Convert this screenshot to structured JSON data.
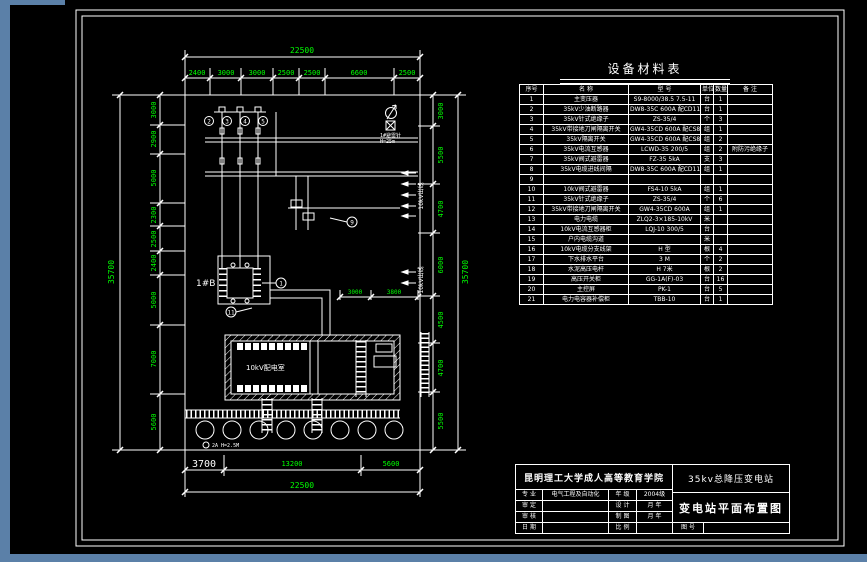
{
  "colors": {
    "backdrop": "#5b80a8",
    "paper": "#000000",
    "line": "#ffffff",
    "dim": "#00ff00"
  },
  "equipment_table": {
    "title": "设备材料表",
    "columns": [
      "序号",
      "名  称",
      "型    号",
      "单位",
      "数量",
      "备 注"
    ],
    "rows": [
      {
        "no": "1",
        "name": "主变压器",
        "model": "S9-8000/38.5 7.5-11",
        "unit": "台",
        "qty": "1",
        "note": ""
      },
      {
        "no": "2",
        "name": "35kV少油断路器",
        "model": "DW8-35C 600A 配CD11-3",
        "unit": "台",
        "qty": "1",
        "note": ""
      },
      {
        "no": "3",
        "name": "35kV针式绝缘子",
        "model": "ZS-35/4",
        "unit": "个",
        "qty": "3",
        "note": ""
      },
      {
        "no": "4",
        "name": "35kV带接地刀闸隔离开关",
        "model": "GW4-35CD 600A 配CS8-6D机构",
        "unit": "组",
        "qty": "1",
        "note": ""
      },
      {
        "no": "5",
        "name": "35kV隔离开关",
        "model": "GW4-35CD 600A 配CS8-6D",
        "unit": "组",
        "qty": "2",
        "note": ""
      },
      {
        "no": "6",
        "name": "35kV电流互感器",
        "model": "LCWD-35 200/5",
        "unit": "组",
        "qty": "2",
        "note": "附防污绝缘子"
      },
      {
        "no": "7",
        "name": "35kV阀式避雷器",
        "model": "FZ-35 5kA",
        "unit": "支",
        "qty": "3",
        "note": ""
      },
      {
        "no": "8",
        "name": "35kV电缆进线间隔",
        "model": "DW8-35C 600A 配CD11、CS8-6D 及CT、PT各1组",
        "unit": "组",
        "qty": "1",
        "note": ""
      },
      {
        "no": "9",
        "name": "",
        "model": "",
        "unit": "",
        "qty": "",
        "note": ""
      },
      {
        "no": "10",
        "name": "10kV阀式避雷器",
        "model": "FS4-10 5kA",
        "unit": "组",
        "qty": "1",
        "note": ""
      },
      {
        "no": "11",
        "name": "35kV针式绝缘子",
        "model": "ZS-35/4",
        "unit": "个",
        "qty": "6",
        "note": ""
      },
      {
        "no": "12",
        "name": "35kV带接地刀闸隔离开关",
        "model": "GW4-35CD 600A",
        "unit": "组",
        "qty": "1",
        "note": ""
      },
      {
        "no": "13",
        "name": "电力电缆",
        "model": "ZLQ2-3×185-10kV",
        "unit": "米",
        "qty": "",
        "note": ""
      },
      {
        "no": "14",
        "name": "10kV电流互感器柜",
        "model": "LQJ-10 300/5",
        "unit": "台",
        "qty": "",
        "note": ""
      },
      {
        "no": "15",
        "name": "户内电缆沟道",
        "model": "",
        "unit": "米",
        "qty": "",
        "note": ""
      },
      {
        "no": "16",
        "name": "10kV电缆分支线架",
        "model": "H 型",
        "unit": "根",
        "qty": "4",
        "note": ""
      },
      {
        "no": "17",
        "name": "下水排水平台",
        "model": "3 M",
        "unit": "个",
        "qty": "2",
        "note": ""
      },
      {
        "no": "18",
        "name": "水泥高压电杆",
        "model": "H 7米",
        "unit": "根",
        "qty": "2",
        "note": ""
      },
      {
        "no": "19",
        "name": "高压开关柜",
        "model": "GG-1A(F)-03",
        "unit": "台",
        "qty": "16",
        "note": ""
      },
      {
        "no": "20",
        "name": "主控屏",
        "model": "PK-1",
        "unit": "台",
        "qty": "5",
        "note": ""
      },
      {
        "no": "21",
        "name": "电力电容器补偿柜",
        "model": "TBB-10",
        "unit": "台",
        "qty": "1",
        "note": ""
      }
    ]
  },
  "title_block": {
    "school": "昆明理工大学成人高等教育学院",
    "project": "35kv总降压变电站",
    "drawing": "变电站平面布置图",
    "fig_label": "图 号",
    "fig_value": "",
    "fields": [
      {
        "l1": "专 业",
        "v1": "电气工程及自动化",
        "l2": "年 级",
        "v2": "2004级"
      },
      {
        "l1": "审 定",
        "v1": "",
        "l2": "设 计",
        "v2": "月 年"
      },
      {
        "l1": "审 核",
        "v1": "",
        "l2": "制 图",
        "v2": "月 年"
      },
      {
        "l1": "日 期",
        "v1": "",
        "l2": "比 例",
        "v2": ""
      }
    ]
  },
  "dimensions": {
    "top": {
      "overall": "22500",
      "segments": [
        "2400",
        "3000",
        "3000",
        "2500",
        "2500",
        "6600",
        "2500"
      ]
    },
    "bottom": {
      "overall": "22500",
      "segments": [
        "3700",
        "13200",
        "5600"
      ]
    },
    "left": {
      "overall": "35700",
      "segments": [
        "3000",
        "2900",
        "5000",
        "2300",
        "2500",
        "2400",
        "5000",
        "7000",
        "5600"
      ]
    },
    "right": {
      "overall": "35700",
      "segments": [
        "3000",
        "5500",
        "4700",
        "6000",
        "4500",
        "4700",
        "5500"
      ]
    },
    "inner": [
      "3000",
      "3800"
    ]
  },
  "plan": {
    "transformer_label": "1#B",
    "building_label": "10kV配电室",
    "rod_note_1": "1#避雷针",
    "rod_note_2": "H=25m",
    "circle_note": "2A H=2.5M",
    "feeder_label_1": "10kV出线",
    "feeder_label_2": "10kV出线",
    "callouts": [
      "2",
      "3",
      "4",
      "5",
      "1",
      "11",
      "9"
    ]
  }
}
